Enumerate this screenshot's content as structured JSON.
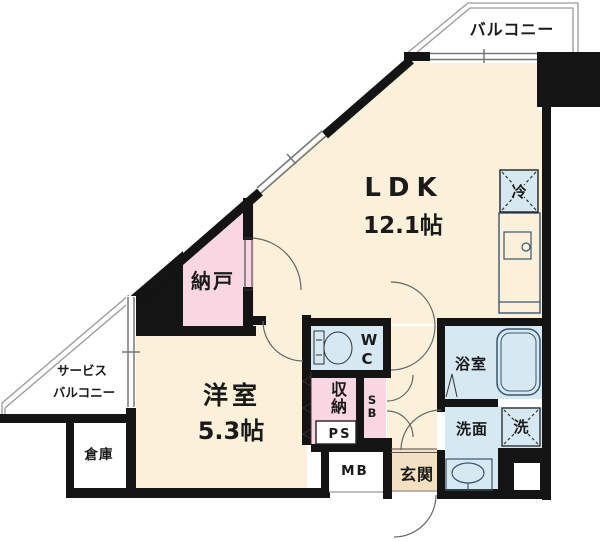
{
  "floor_plan": {
    "balcony": {
      "label": "バルコニー"
    },
    "service_balcony": {
      "label_line1": "サービス",
      "label_line2": "バルコニー"
    },
    "ldk": {
      "label": "LDK",
      "size": "12.1帖"
    },
    "western_room": {
      "label": "洋室",
      "size": "5.3帖"
    },
    "storage_room": {
      "label": "納戸"
    },
    "warehouse": {
      "label": "倉庫"
    },
    "toilet": {
      "label_line1": "W",
      "label_line2": "C"
    },
    "closet": {
      "label_line1": "収",
      "label_line2": "納"
    },
    "shaft_sb": {
      "label_line1": "S",
      "label_line2": "B"
    },
    "pipe_space": {
      "label": "PS"
    },
    "meter_box": {
      "label": "MB"
    },
    "entrance": {
      "label": "玄関"
    },
    "bathroom": {
      "label": "浴室"
    },
    "washroom": {
      "label": "洗面"
    },
    "washing_machine": {
      "label": "洗"
    },
    "refrigerator": {
      "label": "冷"
    },
    "colors": {
      "wall": "#141414",
      "room_cream": "#FBF0DA",
      "room_pink": "#F8D7E2",
      "room_blue": "#D6E8F2",
      "entrance_tan": "#F3E0C2",
      "fixture_blue": "#DCEAF4"
    }
  }
}
